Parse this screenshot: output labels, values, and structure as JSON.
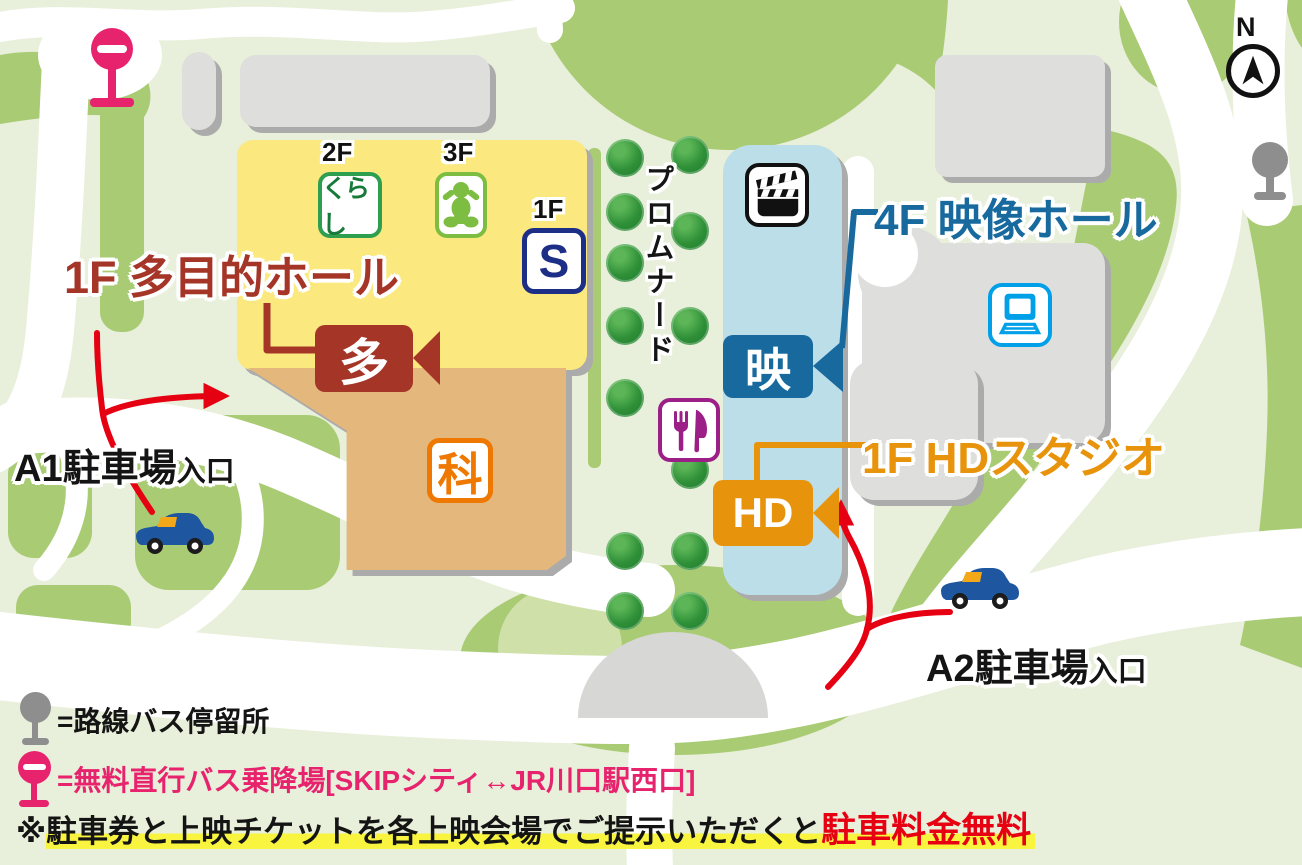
{
  "compass": {
    "label": "N"
  },
  "promenade": {
    "label": "プロムナード"
  },
  "annotations": {
    "multipurpose_hall": {
      "label": "1F 多目的ホール",
      "color": "#A53527"
    },
    "visual_hall": {
      "label": "4F 映像ホール",
      "color": "#17699E"
    },
    "hd_studio": {
      "label": "1F HDスタジオ",
      "color": "#E8930C"
    },
    "a1": {
      "name": "A1駐車場",
      "suffix": "入口"
    },
    "a2": {
      "name": "A2駐車場",
      "suffix": "入口"
    }
  },
  "badges": {
    "floor2": {
      "label": "2F",
      "text": "くらし"
    },
    "floor3": {
      "label": "3F"
    },
    "floor1s": {
      "label": "1F",
      "text": "S"
    },
    "science": {
      "text": "科"
    },
    "camera_multi": {
      "text": "多"
    },
    "camera_visual": {
      "text": "映"
    },
    "camera_hd": {
      "text": "HD"
    }
  },
  "legend": {
    "route_bus": "=路線バス停留所",
    "free_bus": "=無料直行バス乗降場",
    "free_bus_route": "[SKIPシティ↔JR川口駅西口]",
    "note_mark": "※",
    "note_text": "駐車券と上映チケットを各上映会場でご提示いただくと",
    "note_highlight": "駐車料金無料"
  },
  "colors": {
    "background": "#E8EFDA",
    "grass": "#A9CB74",
    "road": "#FFFFFF",
    "building_gray": "#DEDEDC",
    "building_yellow": "#FBE97F",
    "building_tan": "#E4B87C",
    "building_blue": "#BCDEE9",
    "dark_red": "#A53527",
    "hall_blue": "#17699E",
    "studio_orange": "#E8930C",
    "arrow_red": "#E50012",
    "pink": "#E8236E",
    "highlight_yellow": "#F8F440"
  }
}
